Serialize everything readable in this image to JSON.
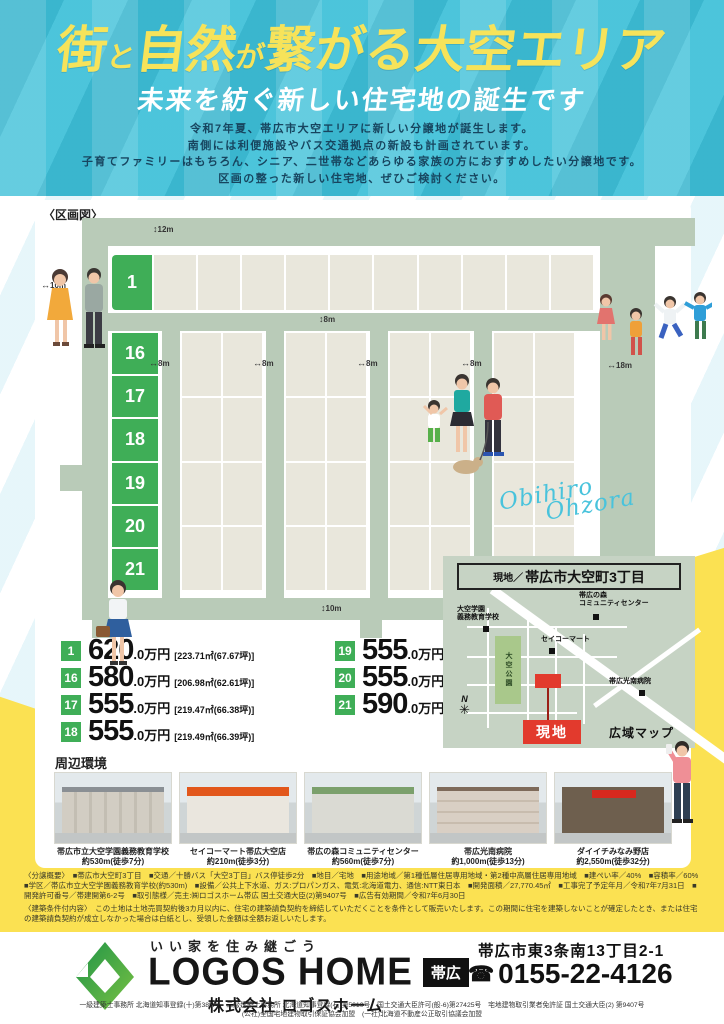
{
  "header": {
    "title_segments": [
      {
        "text": "街",
        "size": "big"
      },
      {
        "text": "と",
        "size": "small"
      },
      {
        "text": "自然",
        "size": "big"
      },
      {
        "text": "が",
        "size": "small"
      },
      {
        "text": "繋がる",
        "size": "big"
      },
      {
        "text": "大空エリア",
        "size": "big"
      }
    ],
    "subtitle": "未来を紡ぐ新しい住宅地の誕生です",
    "description_lines": [
      "令和7年夏、帯広市大空エリアに新しい分譲地が誕生します。",
      "南側には利便施設やバス交通拠点の新設も計画されています。",
      "子育てファミリーはもちろん、シニア、二世帯などあらゆる家族の方におすすめしたい分譲地です。",
      "区画の整った新しい住宅地、ぜひご検討ください。"
    ]
  },
  "plan": {
    "label": "〈区画図〉",
    "green_lots": [
      "1",
      "16",
      "17",
      "18",
      "19",
      "20",
      "21"
    ],
    "dims": {
      "top": "12m",
      "left": "10m",
      "mid": "8m",
      "c1": "8m",
      "c2": "8m",
      "c3": "8m",
      "c4": "8m",
      "right": "18m",
      "bottom": "10m"
    }
  },
  "prices": [
    {
      "lot": "1",
      "amount": "620",
      "suffix": ".0万円",
      "area": "[223.71㎡(67.67坪)]"
    },
    {
      "lot": "16",
      "amount": "580",
      "suffix": ".0万円",
      "area": "[206.98㎡(62.61坪)]"
    },
    {
      "lot": "17",
      "amount": "555",
      "suffix": ".0万円",
      "area": "[219.47㎡(66.38坪)]"
    },
    {
      "lot": "18",
      "amount": "555",
      "suffix": ".0万円",
      "area": "[219.49㎡(66.39坪)]"
    },
    {
      "lot": "19",
      "amount": "555",
      "suffix": ".0万円",
      "area": "[219.48㎡(66.39坪)]"
    },
    {
      "lot": "20",
      "amount": "555",
      "suffix": ".0万円",
      "area": "[219.48㎡(66.39坪)]"
    },
    {
      "lot": "21",
      "amount": "590",
      "suffix": ".0万円",
      "area": "[206.98㎡(62.61坪)]"
    }
  ],
  "location_map": {
    "title_small": "現地／",
    "title_main": "帯広市大空町3丁目",
    "labels": {
      "school1": "大空学園",
      "school2": "義務教育学校",
      "community1": "帯広の森",
      "community2": "コミュニティセンター",
      "seicomart": "セイコーマート",
      "park": "大空公園",
      "hospital": "帯広光南病院",
      "site": "現地",
      "wide_map": "広域マップ",
      "compass": "N"
    }
  },
  "script_text": {
    "word1": "Obihiro",
    "word2": "Ohzora"
  },
  "surroundings": {
    "label": "周辺環境",
    "items": [
      {
        "name": "帯広市立大空学園義務教育学校",
        "distance": "約530m(徒歩7分)"
      },
      {
        "name": "セイコーマート帯広大空店",
        "distance": "約210m(徒歩3分)"
      },
      {
        "name": "帯広の森コミュニティセンター",
        "distance": "約560m(徒歩7分)"
      },
      {
        "name": "帯広光南病院",
        "distance": "約1,000m(徒歩13分)"
      },
      {
        "name": "ダイイチみなみ野店",
        "distance": "約2,550m(徒歩32分)"
      }
    ]
  },
  "fineprint": {
    "outline": "〈分譲概要〉　■帯広市大空町3丁目　■交通／十勝バス「大空3丁目」バス停徒歩2分　■地目／宅地　■用途地域／第1種低層住居専用地域・第2種中高層住居専用地域　■建ぺい率／40%　■容積率／60%　■学区／帯広市立大空学園義務教育学校(約530m)　■設備／公共上下水道、ガス:プロパンガス、電気:北海道電力、通信:NTT東日本　■開発面積／27,770.45㎡　■工事完了予定年月／令和7年7月31日　■開発許可番号／帯建開第6-2号　■取引態様／売主:㈱ロゴスホーム帯広 国土交通大臣(2)第9407号　■広告有効期間／令和7年6月30日",
    "conditions": "〈建築条件付内容〉　この土地は土地売買契約後3カ月以内に、住宅の建築請負契約を締結していただくことを条件として販売いたします。この期間に住宅を建築しないことが確定したとき、または住宅の建築請負契約が成立しなかった場合は白紙とし、受領した金額は全額お返しいたします。"
  },
  "footer": {
    "tagline": "いい家を住み継ごう",
    "brand": "LOGOS HOME",
    "branch_badge": "帯広",
    "company": "株式会社 ロゴスホーム",
    "address": "帯広市東3条南13丁目2-1",
    "phone": "0155-22-4126",
    "registrations": [
      "一級建築士事務所 北海道知事登録(十)第385号　二級建築士事務所 北海道知事登録(石)第5010号　国土交通大臣許可(般-6)第27425号　宅地建物取引業者免許証 国土交通大臣(2) 第9407号",
      "(公社)全国宅地建物取引保証協会加盟　(一社)北海道不動産公正取引協議会加盟"
    ]
  },
  "colors": {
    "header_cyan": "#41c1d9",
    "title_yellow": "#f6e35a",
    "lot_green": "#3fae57",
    "road_sage": "#b9cbb8",
    "lot_beige": "#e9e7dc",
    "accent_yellow": "#fbe152",
    "site_red": "#e23a2d",
    "logo_green": "#2e9e4f"
  }
}
